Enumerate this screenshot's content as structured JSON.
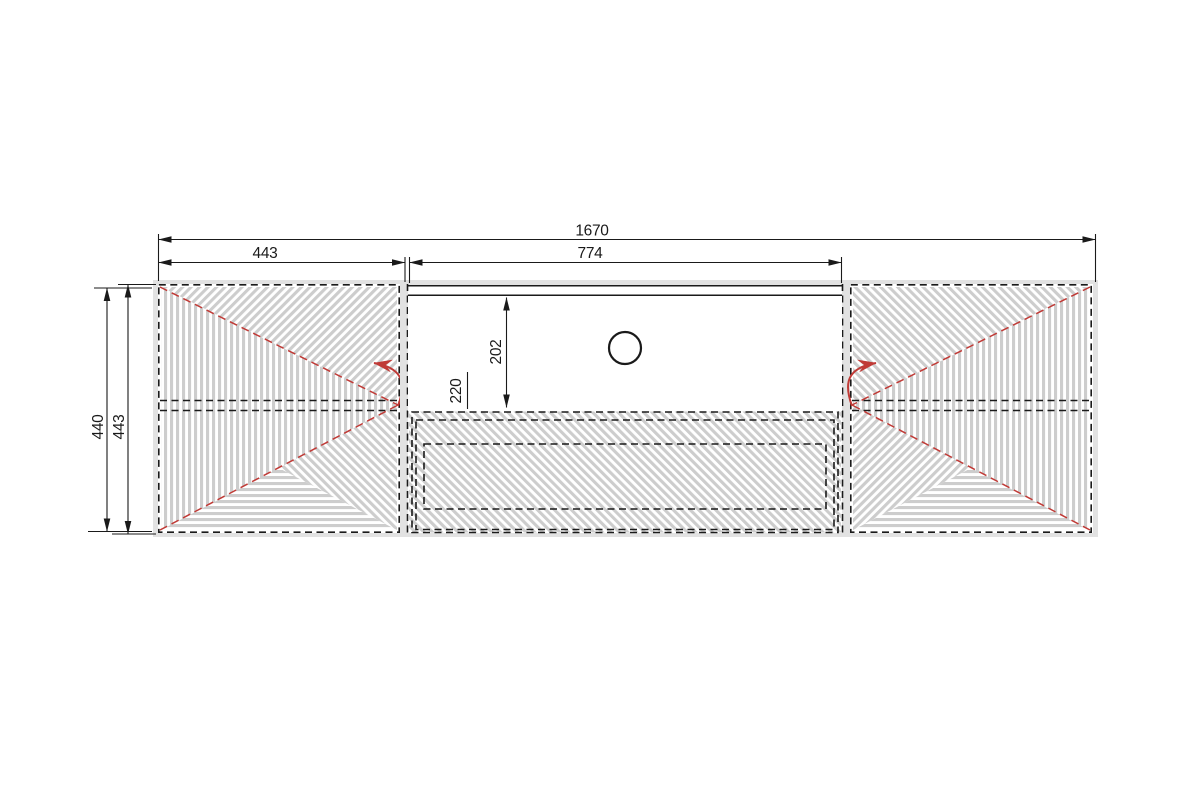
{
  "drawing": {
    "dimensions": {
      "total_width": "1670",
      "left_door_width": "443",
      "niche_width": "774",
      "carcass_height": "440",
      "front_height": "443",
      "niche_inner_height": "202",
      "niche_total_height": "220"
    },
    "colors": {
      "line": "#1a1a1a",
      "hatch": "#cdcdcd",
      "red": "#c03a36",
      "bg": "#ffffff",
      "panel": "#e2e2e2"
    }
  }
}
